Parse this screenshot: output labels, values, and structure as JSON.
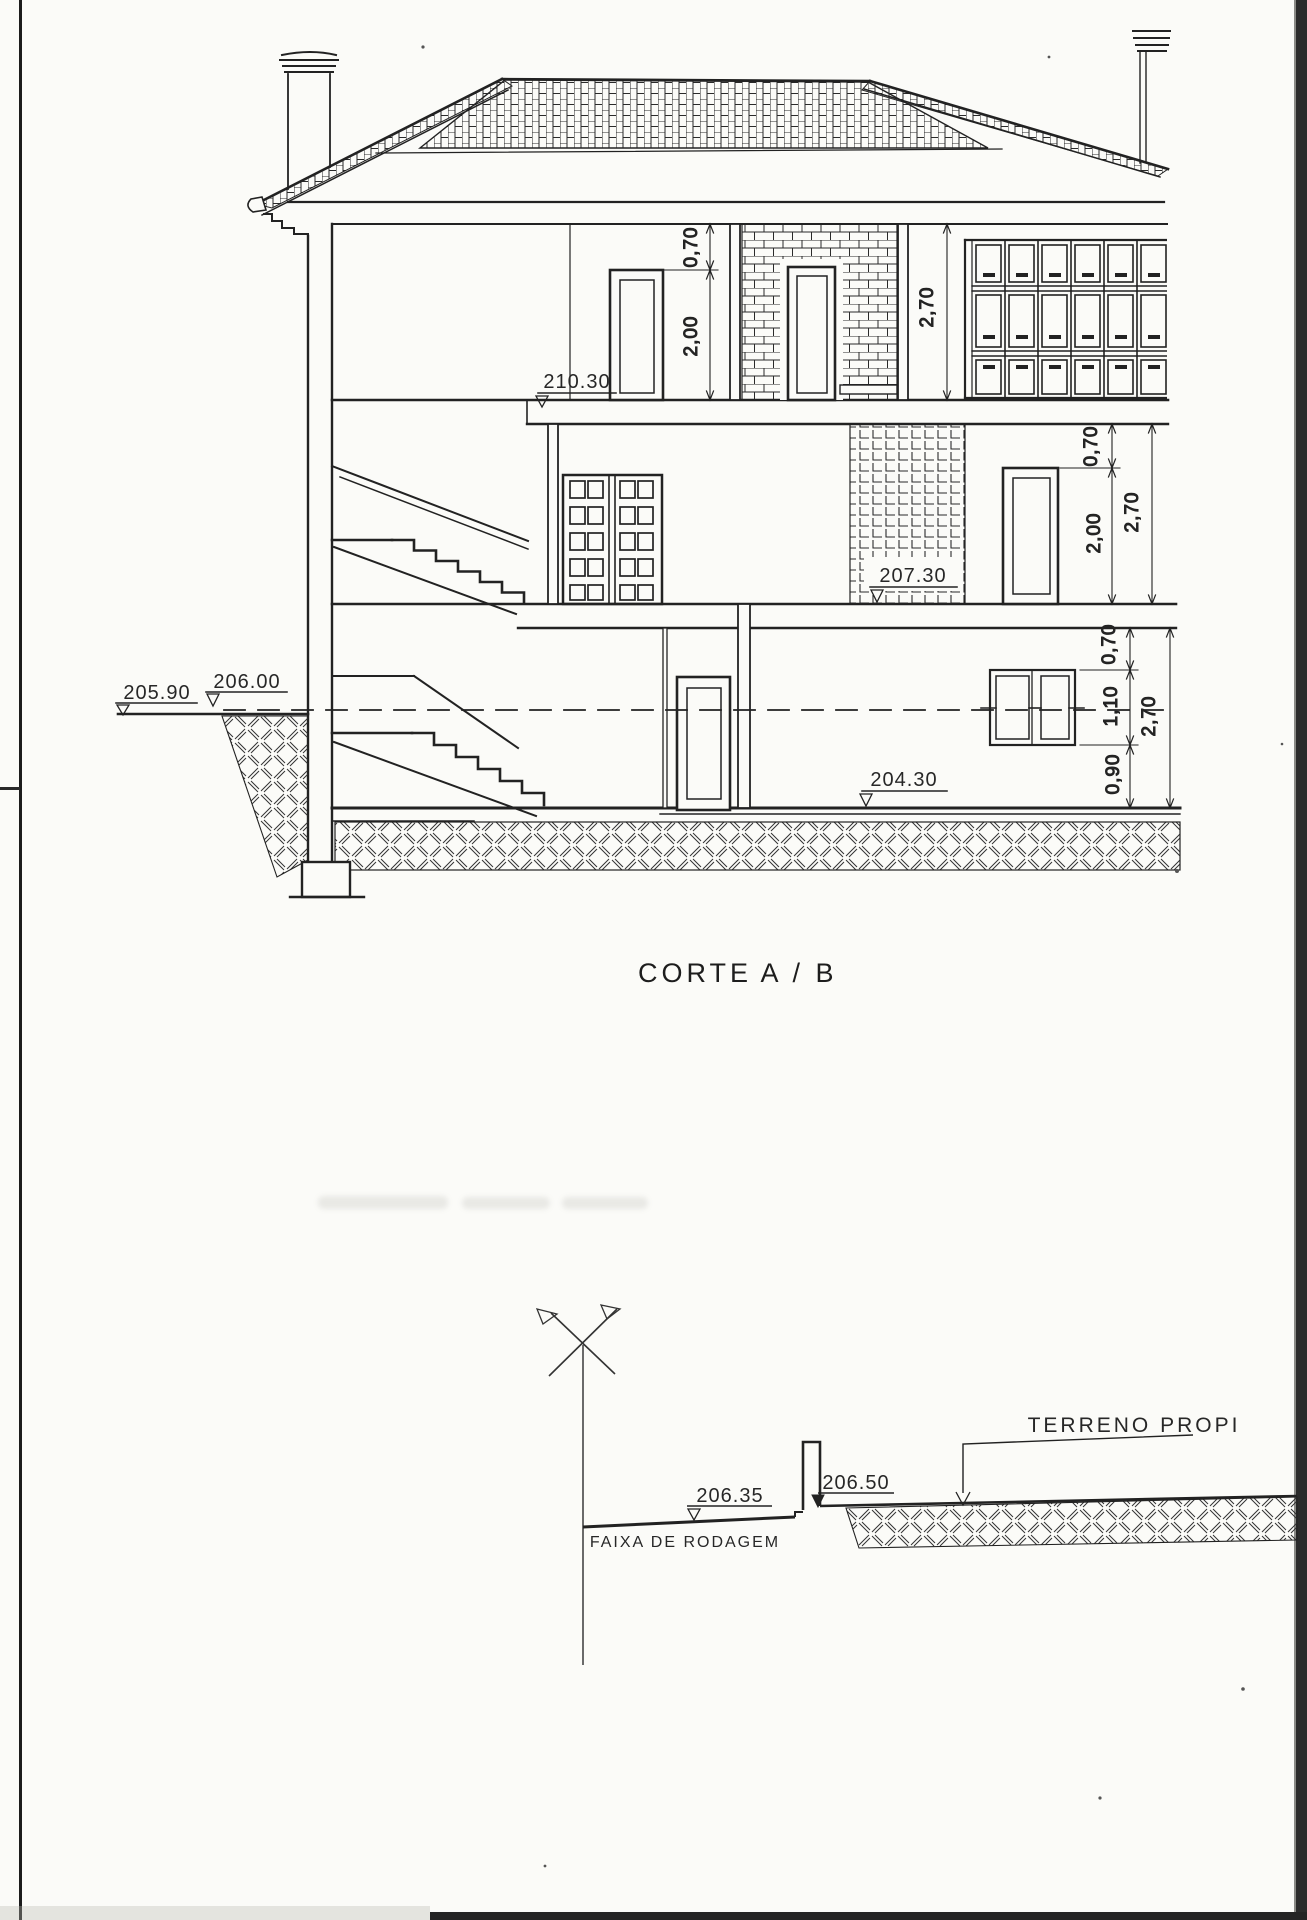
{
  "page": {
    "title_main": "CORTE",
    "title_suffix": "A / B"
  },
  "section_drawing": {
    "floor_levels": {
      "second_floor": "210.30",
      "first_floor": "207.30",
      "ground_floor": "204.30"
    },
    "terrain_levels": {
      "left": "205.90",
      "right": "206.00"
    },
    "dimensions": {
      "second_floor": {
        "lintel": "0,70",
        "door_height": "2,00",
        "storey_height": "2,70"
      },
      "first_floor": {
        "lintel": "0,70",
        "window_height": "2,00",
        "storey_height": "2,70"
      },
      "ground_floor": {
        "lintel": "0,70",
        "window_height": "1,10",
        "sill_height": "0,90",
        "storey_height": "2,70"
      }
    }
  },
  "profile_drawing": {
    "road_level": "206.35",
    "terrain_level": "206.50",
    "road_label": "FAIXA DE RODAGEM",
    "terrain_label": "TERRENO PROPI"
  },
  "colors": {
    "ink": "#222222",
    "paper": "#fbfbf8",
    "scan_edge": "#2b2b2b"
  }
}
